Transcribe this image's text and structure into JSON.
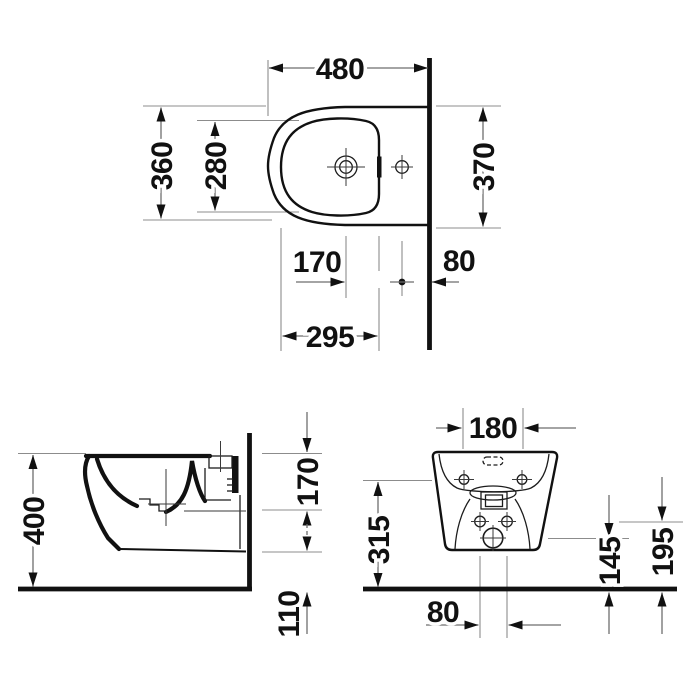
{
  "views": {
    "top": {
      "dims": {
        "overall_depth": "480",
        "outer_width": "360",
        "basin_width": "280",
        "width_at_wall": "370",
        "drain_to_tap": "170",
        "tap_to_wall": "80",
        "basin_length": "295"
      }
    },
    "side": {
      "dims": {
        "overall_height": "400",
        "rim_to_fixing": "170",
        "bottom_to_floor": "110"
      }
    },
    "rear": {
      "dims": {
        "fixing_hole_span": "180",
        "fixing_height": "315",
        "outlet_height": "145",
        "supply_height": "195",
        "lower_span": "80"
      }
    }
  },
  "colors": {
    "ink": "#111111",
    "dimension_line": "#6e6e6e",
    "background": "#ffffff"
  }
}
